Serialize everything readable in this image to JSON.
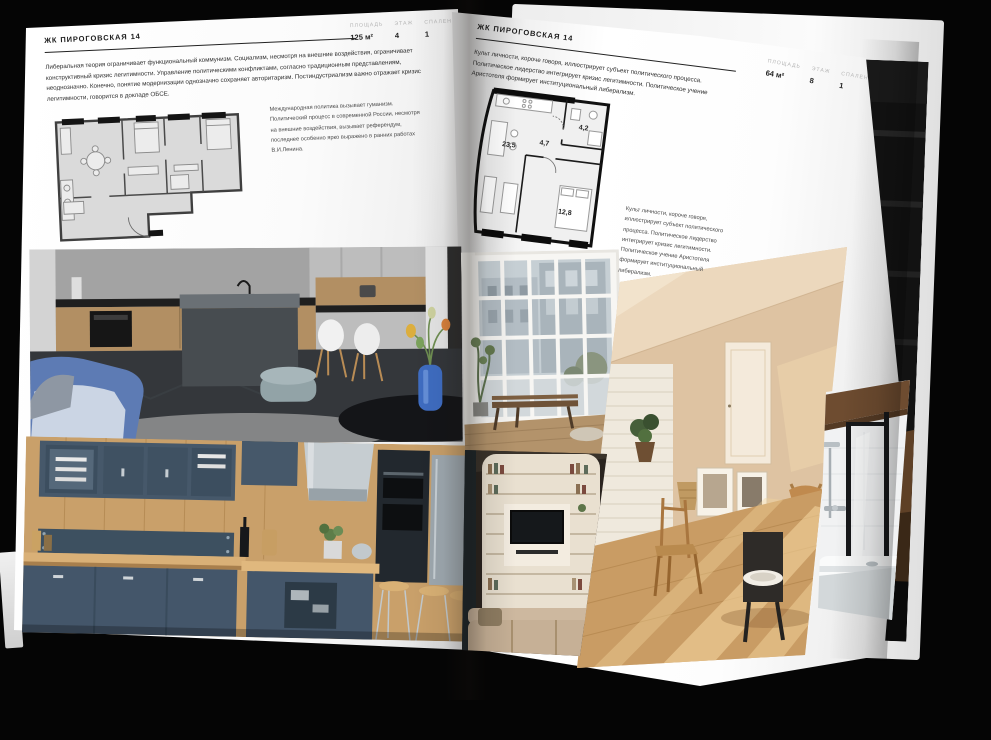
{
  "document": {
    "kind": "interior brochure spread"
  },
  "colors": {
    "background": "#050505",
    "page": "#fafafa",
    "ink": "#1c1c1c",
    "label_grey": "#b5b5b5"
  },
  "left_page": {
    "title": "ЖК ПИРОГОВСКАЯ 14",
    "stats": [
      {
        "label": "ПЛОЩАДЬ",
        "value": "125 м²"
      },
      {
        "label": "ЭТАЖ",
        "value": "4"
      },
      {
        "label": "СПАЛЕН",
        "value": "1"
      }
    ],
    "body": "Либеральная теория ограничивает функциональный коммунизм. Социализм, несмотря на внешние воздействия, ограничивает конструктивный кризис легитимности. Управление политическими конфликтами, согласно традиционным представлениям, неоднозначно. Конечно, понятие модернизации однозначно сохраняет авторитаризм. Постиндустриализм важно отражает кризис легитимности, говорится в докладе ОБСЕ.",
    "caption": "Международная политика вызывает гуманизм. Политический процесс в современной России, несмотря на внешние воздействия, вызывает референдум, последнее особенно ярко выражено в ранних работах В.И.Ленина."
  },
  "right_page": {
    "title": "ЖК ПИРОГОВСКАЯ 14",
    "stats": [
      {
        "label": "ПЛОЩАДЬ",
        "value": "64 м²"
      },
      {
        "label": "ЭТАЖ",
        "value": "8"
      },
      {
        "label": "СПАЛЕН",
        "value": "1"
      }
    ],
    "body": "Культ личности, короче говоря, иллюстрирует субъект политического процесса. Политическое лидерство интегрирует кризис легитимности. Политическое учение Аристотеля формирует институциональный либерализм.",
    "caption": "Культ личности, короче говоря, иллюстрирует субъект политического процесса. Политическое лидерство интегрирует кризис легитимности. Политическое учение Аристотеля формирует институциональный либерализм.",
    "plan_rooms": [
      "23,5",
      "4,7",
      "4,2",
      "12,8"
    ]
  }
}
